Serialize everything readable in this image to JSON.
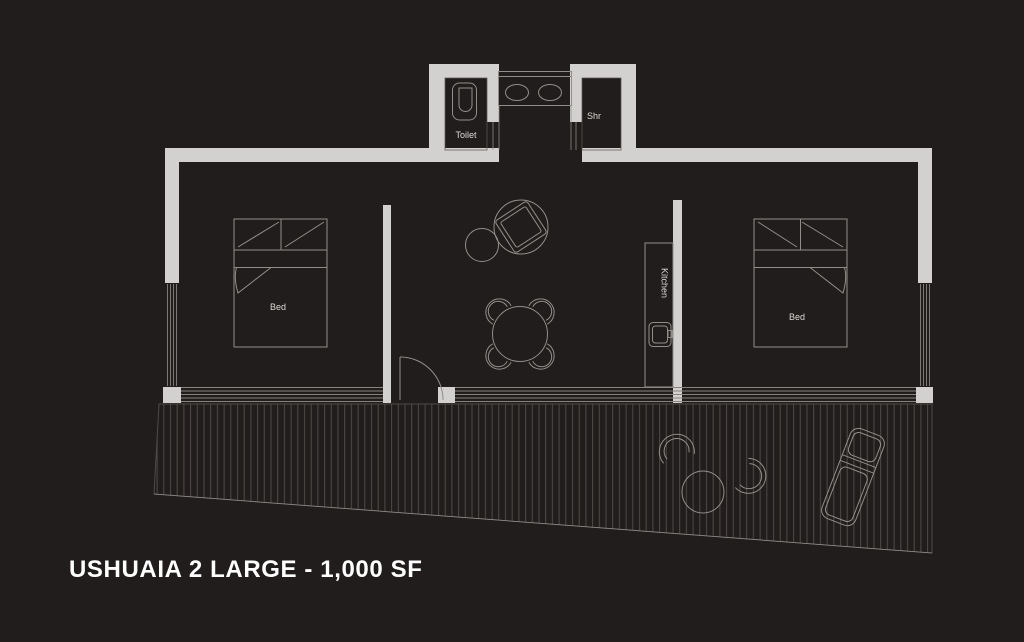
{
  "title": "USHUAIA 2 LARGE - 1,000 SF",
  "labels": {
    "bedroom_left": "Bed",
    "bedroom_right": "Bed",
    "toilet": "Toilet",
    "shower": "Shr",
    "kitchen": "Kitchen"
  },
  "colors": {
    "background": "#211d1c",
    "wall": "#d3d1cf",
    "furniture_line": "#918e8a",
    "deck_hatch": "#4e4a48",
    "glass_line": "#87847f",
    "label_text": "#dcdad7",
    "title_text": "#ffffff"
  }
}
